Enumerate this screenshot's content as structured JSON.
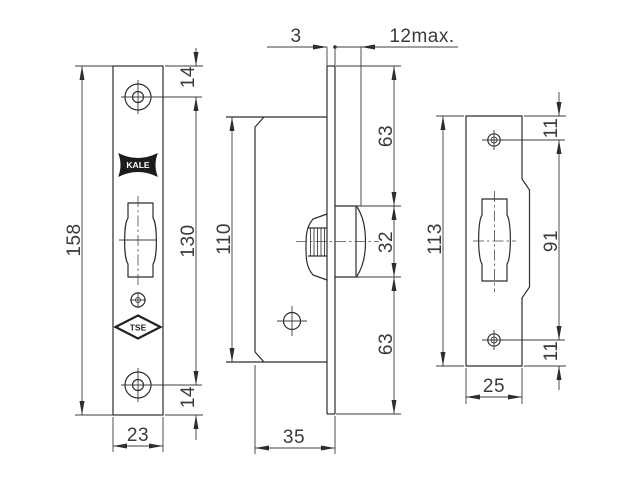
{
  "drawing": {
    "logos": {
      "brand": "KALE",
      "certification": "TSE"
    },
    "dims": {
      "faceplate_height": "158",
      "faceplate_hole_spacing": "130",
      "hole_top_offset": "14",
      "hole_bottom_offset": "14",
      "faceplate_width": "23",
      "faceplate_thickness": "3",
      "knob_protrusion": "12max.",
      "case_height": "110",
      "upper_span": "63",
      "cylinder_height": "32",
      "lower_span": "63",
      "case_depth": "35",
      "strike_height": "113",
      "strike_hole_top_offset": "11",
      "strike_hole_spacing": "91",
      "strike_hole_bottom_offset": "11",
      "strike_width": "25"
    },
    "colors": {
      "line": "#2d2d2d",
      "text": "#3a3a3a",
      "background": "#ffffff"
    }
  }
}
